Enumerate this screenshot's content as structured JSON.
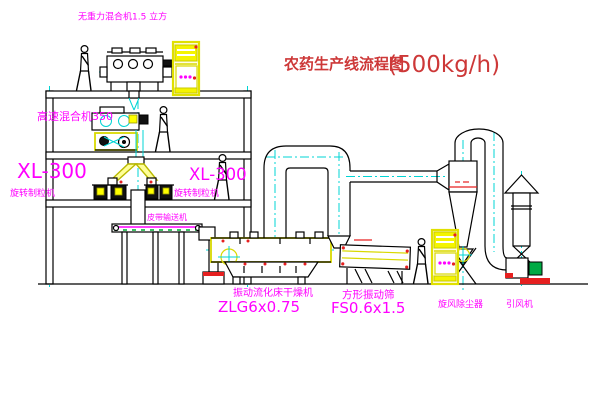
{
  "title": {
    "name_cn": "农药生产线流程图",
    "capacity": "(500kg/h)"
  },
  "labels": {
    "gravity_mixer": "无重力混合机1.5 立方",
    "high_speed_mixer": "高速混合机350",
    "granulator_left_model": "XL-300",
    "granulator_left_name": "旋转制粒机",
    "granulator_right_model": "XL-300",
    "granulator_right_name": "旋转制粒机",
    "belt_conveyor": "皮带输送机",
    "dryer_name": "振动流化床干燥机",
    "dryer_model": "ZLG6x0.75",
    "sieve_name": "方形振动筛",
    "sieve_model": "FS0.6x1.5",
    "cyclone_collector": "旋风除尘器",
    "induced_draft_fan": "引风机"
  },
  "colors": {
    "label_magenta": "#ff00ff",
    "title_red": "#cd3838",
    "equipment_yellow": "#f4f400",
    "centerline_cyan": "#00d4d4",
    "accent_green": "#00aa33",
    "accent_red": "#e62020",
    "line_black": "#000000"
  }
}
